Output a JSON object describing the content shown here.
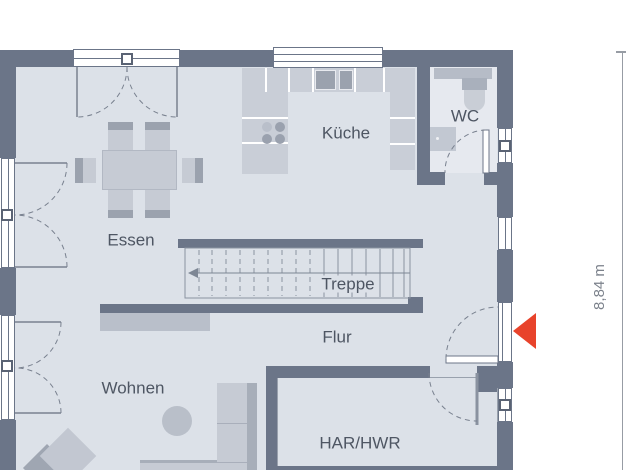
{
  "floorplan": {
    "rooms": [
      {
        "id": "essen",
        "label": "Essen"
      },
      {
        "id": "kueche",
        "label": "Küche"
      },
      {
        "id": "wc",
        "label": "WC"
      },
      {
        "id": "treppe",
        "label": "Treppe"
      },
      {
        "id": "flur",
        "label": "Flur"
      },
      {
        "id": "wohnen",
        "label": "Wohnen"
      },
      {
        "id": "har_hwr",
        "label": "HAR/HWR"
      }
    ],
    "dimensions": {
      "right_height": "8,84 m"
    },
    "icons": {
      "entrance_marker": "left-pointing-triangle"
    },
    "colors": {
      "wall": "#6b7588",
      "floor": "#dce1e8",
      "floor_wc": "#e6e9ef",
      "furniture": "#c6cbd4",
      "furniture_dark": "#9ba2ae",
      "line": "#808a9a",
      "label": "#4e5663",
      "accent": "#e8432b",
      "dimension": "#979ca4",
      "dimension_text": "#7b818b"
    }
  }
}
